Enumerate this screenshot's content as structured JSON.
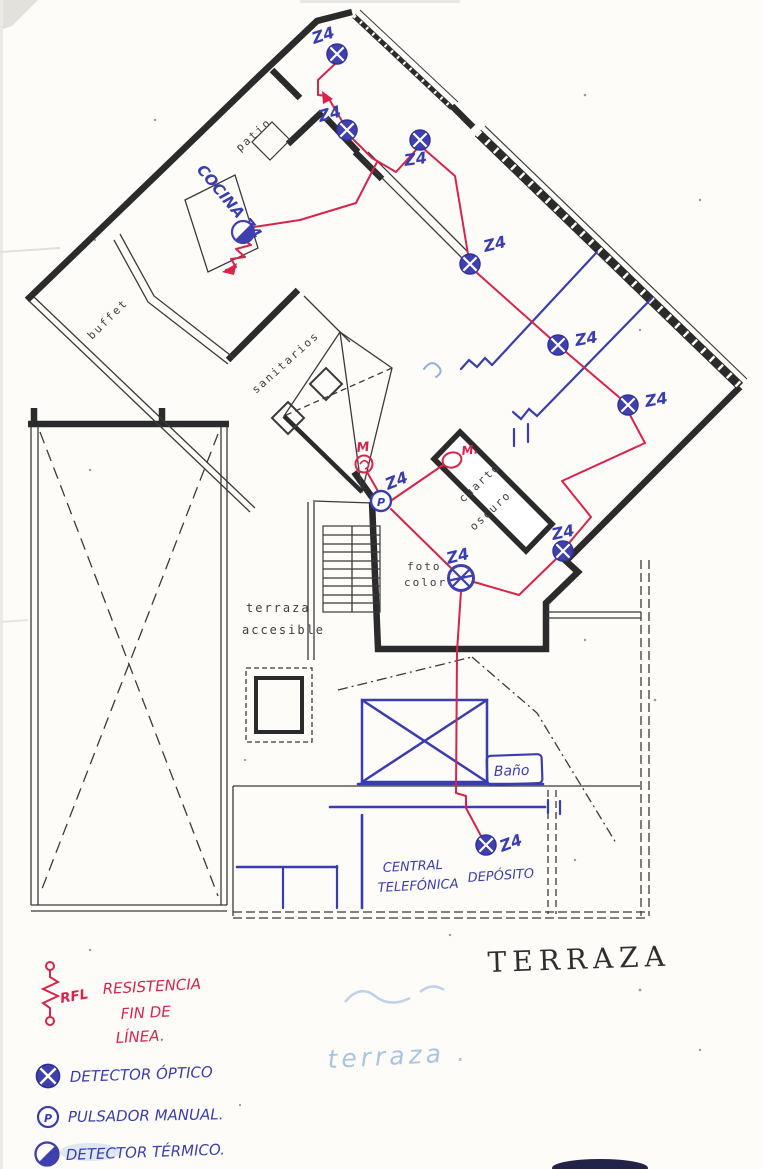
{
  "plan": {
    "zone_label": "Z4",
    "rooms": {
      "patio": "patio",
      "cocina": "COCINA Z4",
      "buffet": "buffet",
      "sanitarios": "sanitarios",
      "cuarto_oscuro": [
        "cuarto",
        "oscuro"
      ],
      "foto_color": [
        "foto",
        "color"
      ],
      "terraza_accesible": [
        "terraza",
        "accesible"
      ],
      "bano": "Baño",
      "central_telefonica": [
        "CENTRAL",
        "TELEFÓNICA"
      ],
      "deposito": "DEPÓSITO"
    },
    "markers": {
      "manual_1": "M",
      "manual_2": "M.",
      "pulsador_letter": "P"
    },
    "titles": {
      "terraza_main": "TERRAZA",
      "terraza_faint": "terraza ."
    }
  },
  "legend": {
    "rfl_abbr": "RFL",
    "rfl_lines": [
      "RESISTENCIA",
      "FIN DE",
      "LÍNEA."
    ],
    "items": [
      {
        "symbol": "optical-detector-icon",
        "label": "DETECTOR ÓPTICO"
      },
      {
        "symbol": "manual-call-point-icon",
        "label": "PULSADOR MANUAL."
      },
      {
        "symbol": "thermal-detector-icon",
        "label": "DETECTOR TÉRMICO."
      }
    ]
  },
  "colors": {
    "ink_blue": "#3a3db0",
    "wiring_red": "#d9234a",
    "pencil": "#2b2b2b",
    "faint_blue": "#a9c3e3"
  }
}
